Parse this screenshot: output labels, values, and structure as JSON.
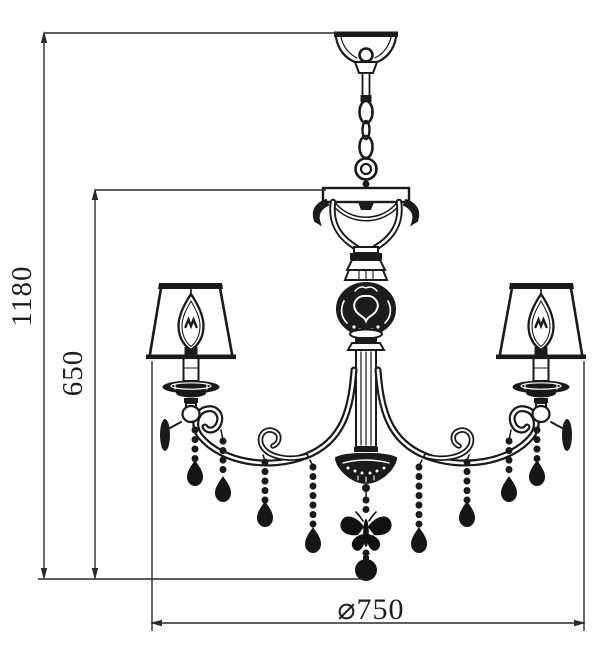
{
  "page": {
    "background": "#ffffff",
    "width": 600,
    "height": 662
  },
  "drawing": {
    "subject": "chandelier technical line drawing",
    "line_color": "#1a1a1a",
    "dimension_line_color": "#2a2a2a",
    "dimensions": {
      "overall_height": "1180",
      "body_height": "650",
      "diameter": "⌀750"
    },
    "parts": [
      "ceiling-canopy",
      "suspension-chain",
      "chain-ring",
      "hanger-plate",
      "yoke-scrolls",
      "ornate-sphere",
      "fluted-column",
      "left-arm",
      "right-arm",
      "lamp-shade",
      "candle-bulb",
      "bobeche",
      "bead-strand",
      "teardrop-pendant",
      "center-bowl",
      "butterfly-ornament",
      "bottom-ball"
    ]
  }
}
